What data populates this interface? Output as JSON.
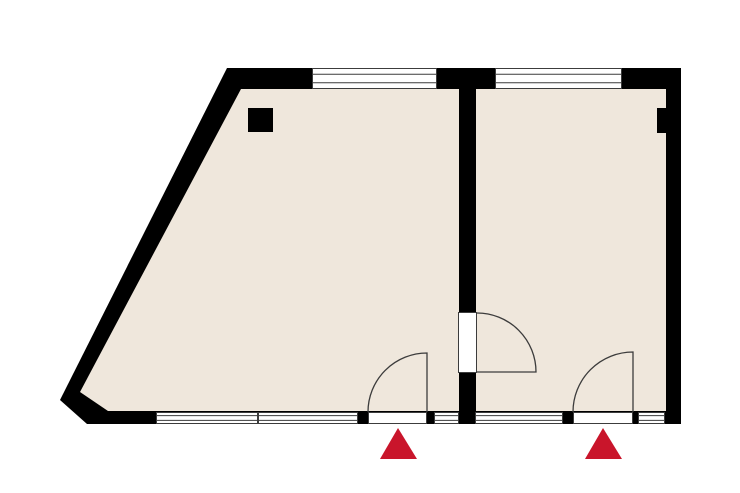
{
  "canvas": {
    "width": 740,
    "height": 493
  },
  "colors": {
    "background": "#ffffff",
    "wall": "#000000",
    "floor": "#efe7dc",
    "frame_line": "#3c3c3c",
    "swing_line": "#3c3c3c",
    "window_fill": "#ffffff",
    "opening_fill": "#ffffff",
    "marker_red": "#c9152b"
  },
  "building": {
    "outer_polygon": "227,68 681,68 681,424 87,424 60,400",
    "floor_polygon": "241,89 666,89 666,411 108,411 80,392",
    "divider_wall": {
      "name": "divider-wall",
      "x": 459,
      "y": 89,
      "w": 17,
      "h": 322
    }
  },
  "columns": [
    {
      "name": "column-left-room",
      "x": 248,
      "y": 108,
      "w": 25,
      "h": 24
    },
    {
      "name": "wall-pier-right",
      "x": 657,
      "y": 108,
      "w": 10,
      "h": 25
    }
  ],
  "windows": [
    {
      "name": "window-top-left",
      "x": 312,
      "y": 68,
      "w": 125,
      "h": 21
    },
    {
      "name": "window-top-right",
      "x": 495,
      "y": 68,
      "w": 127,
      "h": 21
    },
    {
      "name": "window-bottom-1",
      "x": 156,
      "y": 412,
      "w": 102,
      "h": 12
    },
    {
      "name": "window-bottom-2",
      "x": 258,
      "y": 412,
      "w": 100,
      "h": 12
    },
    {
      "name": "window-bottom-3",
      "x": 434,
      "y": 412,
      "w": 25,
      "h": 12
    },
    {
      "name": "window-bottom-4",
      "x": 475,
      "y": 412,
      "w": 88,
      "h": 12
    },
    {
      "name": "window-bottom-5",
      "x": 638,
      "y": 412,
      "w": 27,
      "h": 12
    }
  ],
  "door_openings": [
    {
      "name": "door-opening-left",
      "x": 368,
      "y": 412,
      "w": 59,
      "h": 12
    },
    {
      "name": "door-opening-right",
      "x": 573,
      "y": 412,
      "w": 60,
      "h": 12
    },
    {
      "name": "interior-door-opening",
      "x": 458,
      "y": 312,
      "w": 19,
      "h": 61
    }
  ],
  "door_swings": [
    {
      "name": "door-swing-left",
      "path": "M 368 412 A 59 59 0 0 1 427 353 L 427 412"
    },
    {
      "name": "door-swing-right",
      "path": "M 573 412 A 60 60 0 0 1 633 352 L 633 412"
    },
    {
      "name": "door-swing-interior",
      "path": "M 477 313 A 59 59 0 0 1 536 372 L 477 372"
    }
  ],
  "entrance_markers": [
    {
      "name": "entrance-marker-left",
      "points": "398,428 417,459 380,459"
    },
    {
      "name": "entrance-marker-right",
      "points": "603,428 622,459 585,459"
    }
  ]
}
